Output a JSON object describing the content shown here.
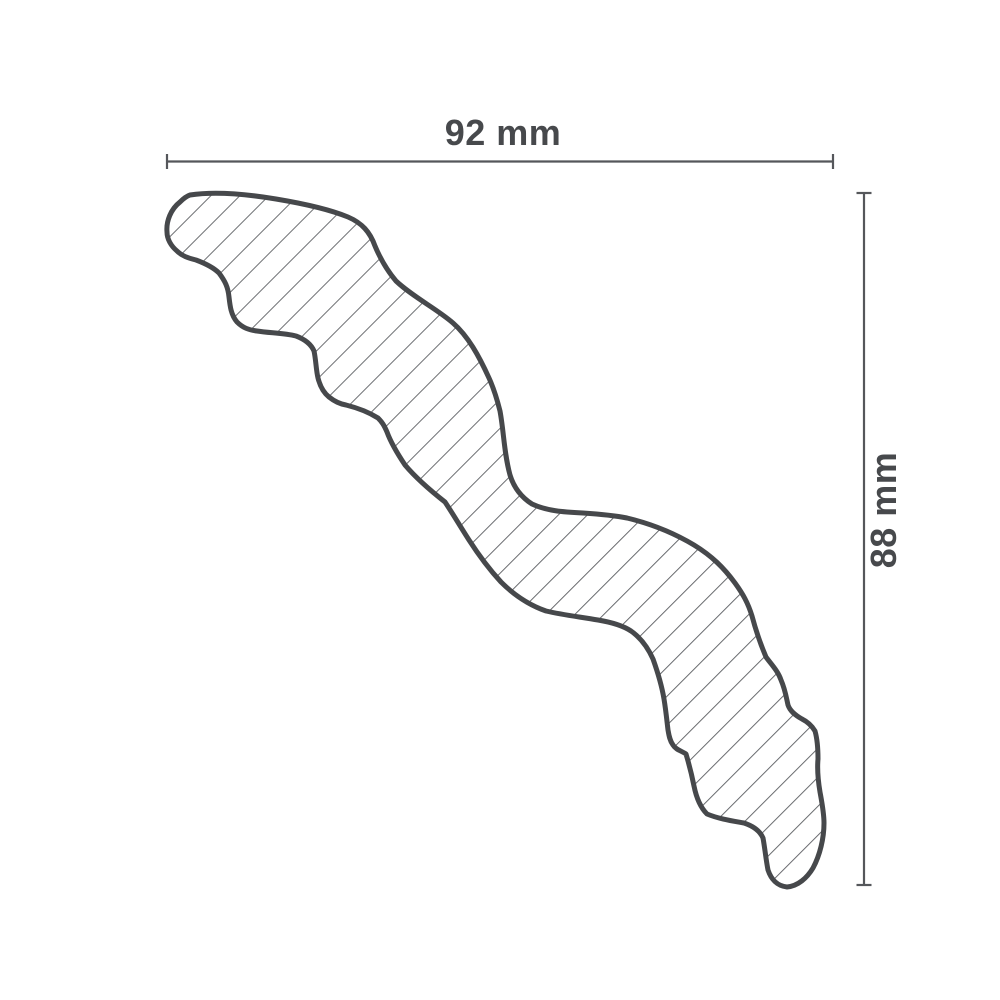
{
  "drawing": {
    "dimensions": {
      "width_label": "92 mm",
      "height_label": "88 mm"
    },
    "profile": {
      "name": "crown-molding-cross-section",
      "fill_style": "diagonal-hatch-45deg"
    },
    "colors": {
      "outline": "#46484b",
      "hatch": "#64666a",
      "dimension_line": "#55575b",
      "label_text": "#47494c",
      "background": "#ffffff"
    }
  }
}
